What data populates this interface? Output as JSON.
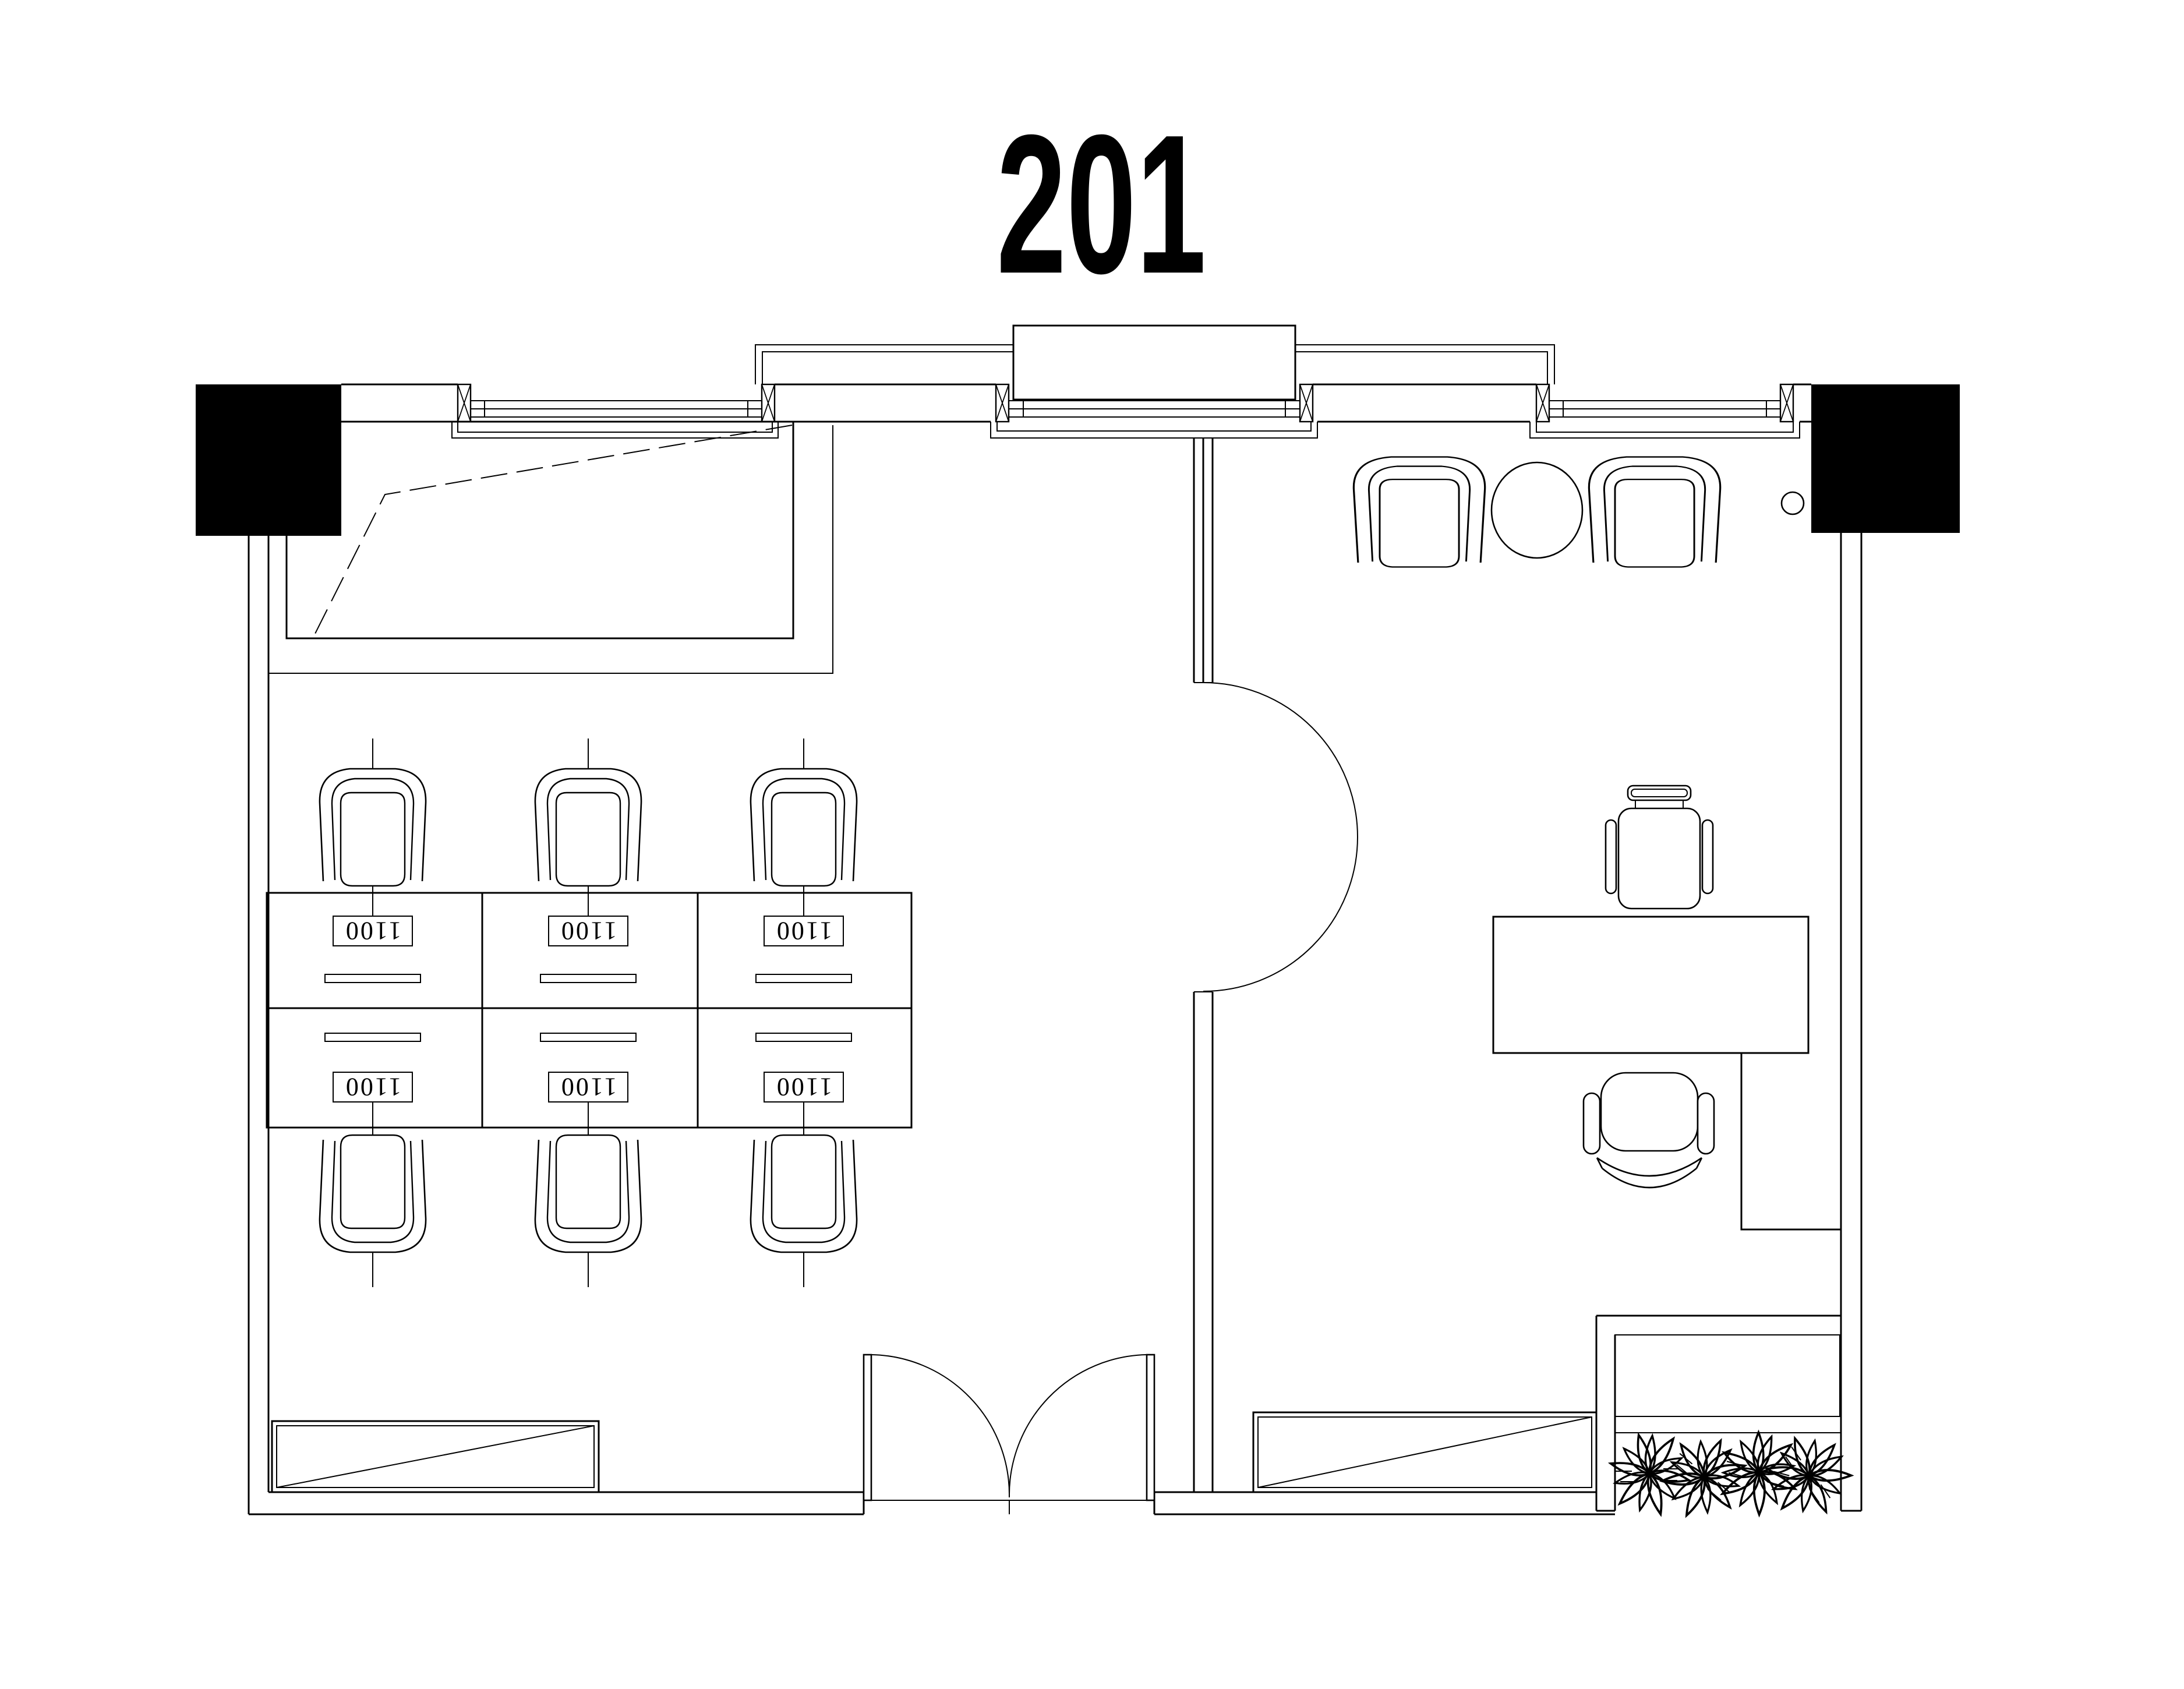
{
  "title": "201",
  "colors": {
    "line": "#000000",
    "background": "#ffffff",
    "column_fill": "#000000"
  },
  "workstations": {
    "desk_labels": [
      "1100",
      "1100",
      "1100",
      "1100",
      "1100",
      "1100"
    ]
  }
}
